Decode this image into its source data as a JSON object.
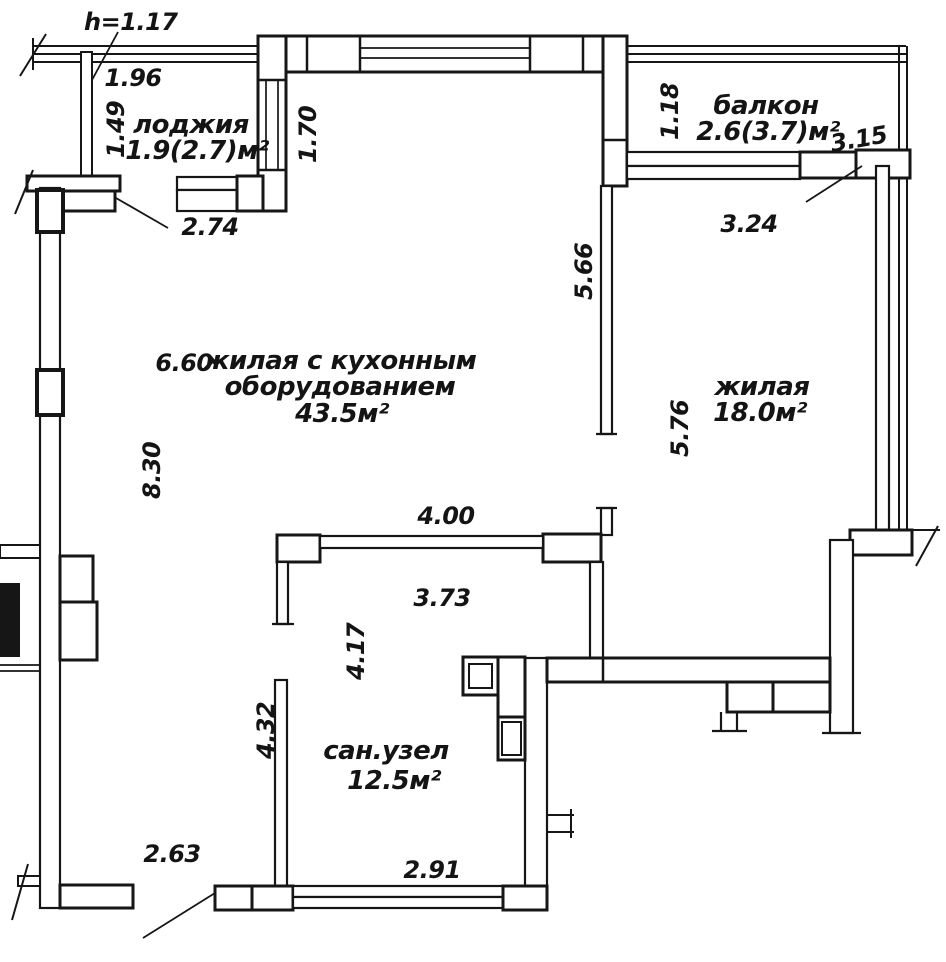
{
  "document": {
    "type": "apartment floor plan (scanned blueprint)",
    "background": "#ffffff",
    "line_color": "#161616"
  },
  "annotations": {
    "ceiling_height": "h=1.17"
  },
  "rooms": [
    {
      "id": "loggia",
      "name": "лоджия",
      "area": "1.9(2.7)м²"
    },
    {
      "id": "balcony",
      "name": "балкон",
      "area": "2.6(3.7)м²"
    },
    {
      "id": "living_kitchen",
      "name": "жилая с кухонным",
      "name2": "оборудованием",
      "area": "43.5м²"
    },
    {
      "id": "living",
      "name": "жилая",
      "area": "18.0м²"
    },
    {
      "id": "bathroom",
      "name": "сан.узел",
      "area": "12.5м²"
    }
  ],
  "dimensions": {
    "loggia_top": "1.96",
    "loggia_left": "1.49",
    "loggia_right": "1.70",
    "loggia_bottom": "2.74",
    "balcony_left": "1.18",
    "balcony_right": "3.15",
    "balcony_bottom": "3.24",
    "partition_upper": "5.66",
    "living_kitchen_width": "6.60",
    "living_kitchen_depth": "8.30",
    "living_depth": "5.76",
    "opening_width": "4.00",
    "bathroom_top_width": "3.73",
    "bathroom_left_upper": "4.17",
    "bathroom_left_lower": "4.32",
    "bottom_left_width": "2.63",
    "bathroom_bottom_width": "2.91"
  }
}
